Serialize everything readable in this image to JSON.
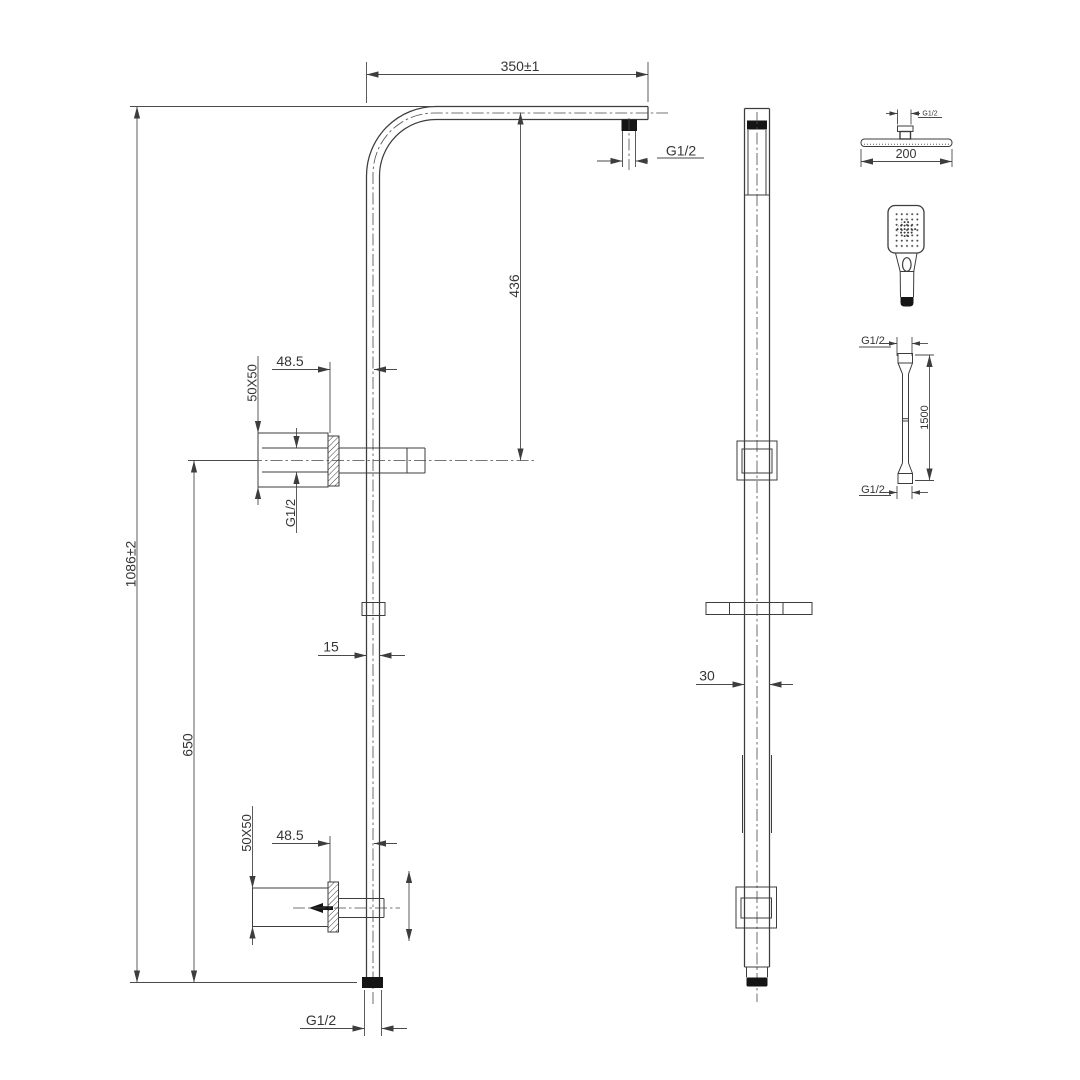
{
  "drawing": {
    "title": "shower-rail-technical-drawing",
    "colors": {
      "background": "#ffffff",
      "line": "#3d3d3d",
      "fill_black": "#151515"
    }
  },
  "front_view": {
    "dim_width_top": "350±1",
    "thread_arm": "G1/2",
    "dim_drop": "436",
    "dim_total_height": "1086±2",
    "dim_bottom_span": "650",
    "upper_bracket": {
      "offset": "48.5",
      "plate": "50X50",
      "thread": "G1/2"
    },
    "dim_rail_width": "15",
    "lower_bracket": {
      "offset": "48.5",
      "plate": "50X50"
    },
    "thread_bottom": "G1/2"
  },
  "side_view": {
    "dim_rail_depth": "30"
  },
  "components": {
    "shower_head": {
      "thread": "G1/2",
      "dim_width": "200"
    },
    "hose": {
      "thread_top": "G1/2",
      "length": "1500",
      "thread_bottom": "G1/2"
    }
  }
}
